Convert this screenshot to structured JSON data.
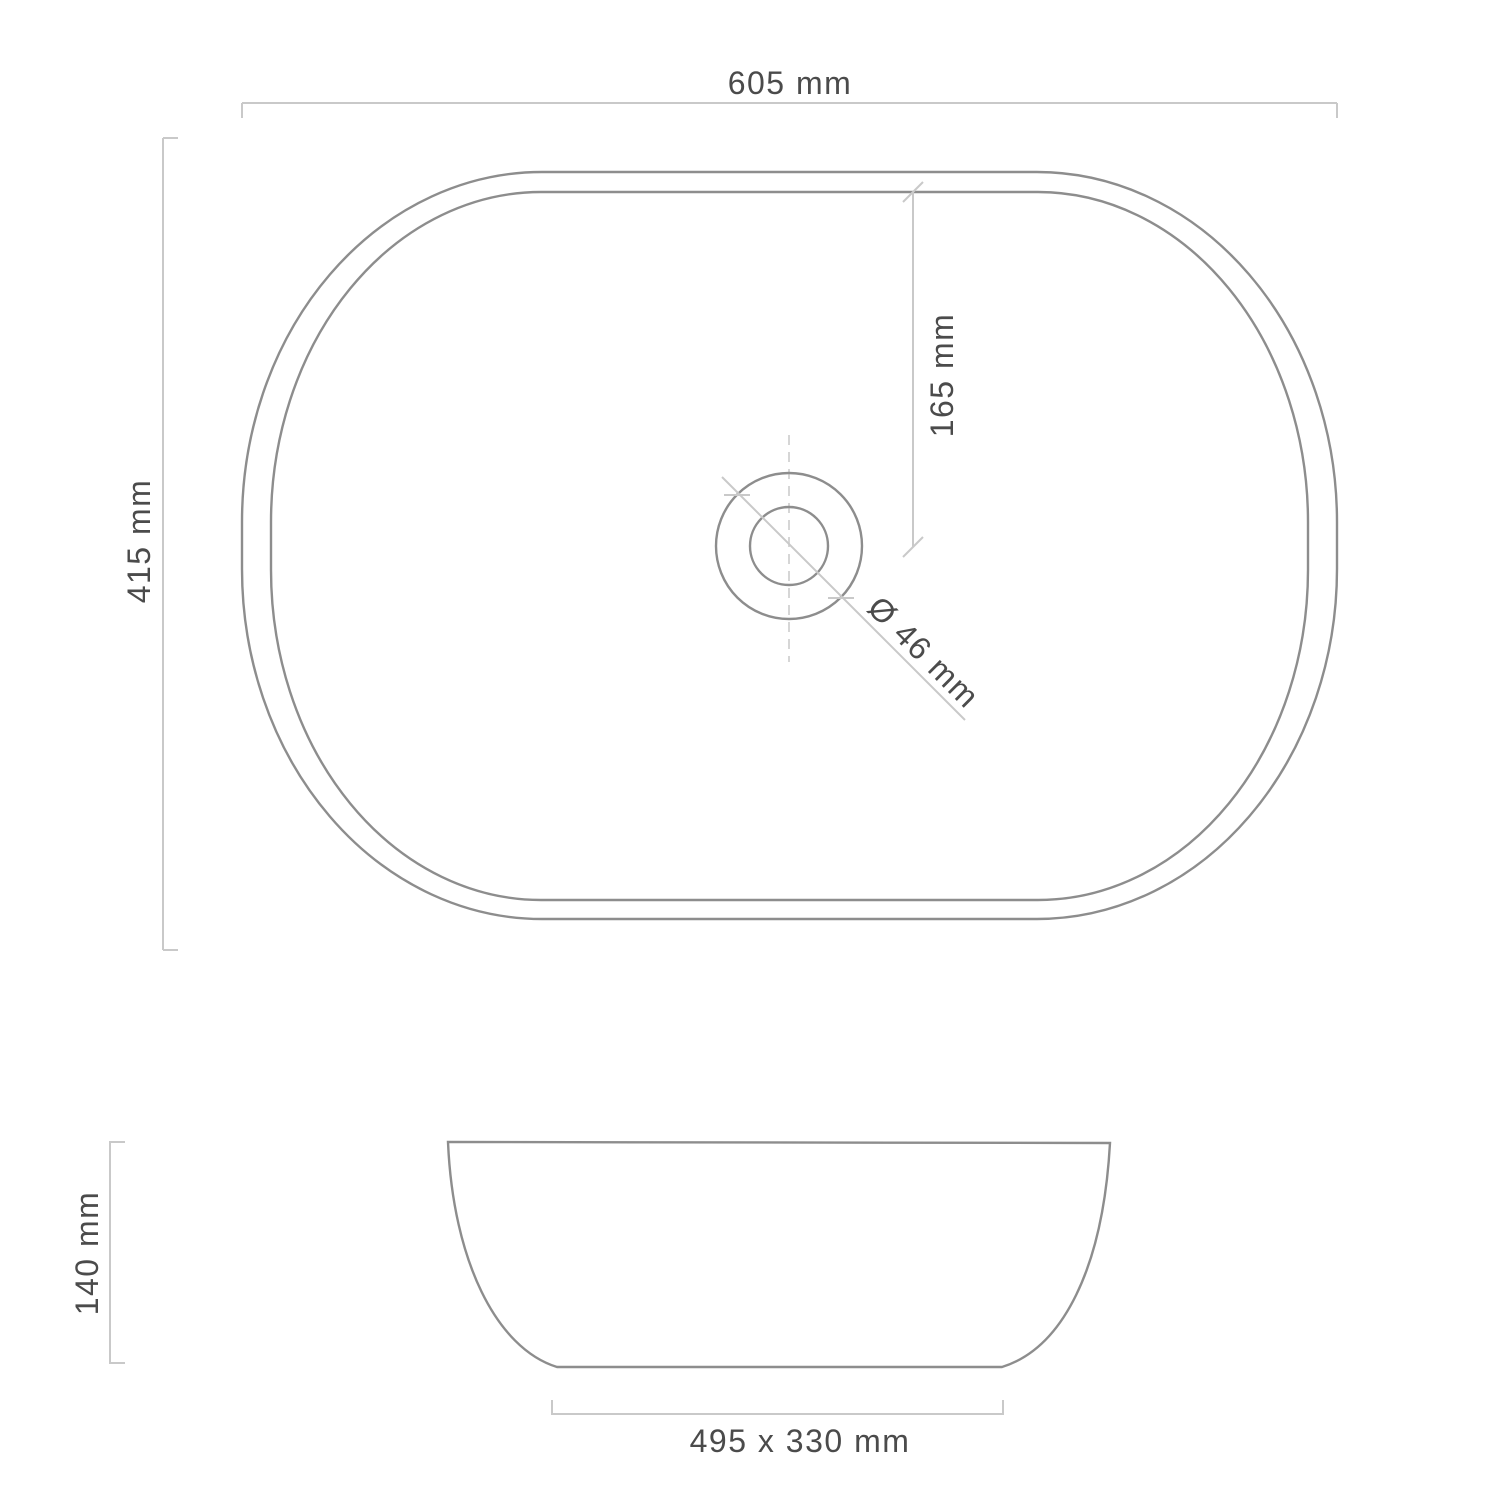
{
  "drawing": {
    "title": "Vessel basin technical drawing",
    "background_color": "#ffffff",
    "colors": {
      "object_line": "#8d8d8d",
      "dimension_line": "#c9c9c9",
      "centerline": "#d2d2d2",
      "label_text": "#4b4b4b"
    },
    "top_view": {
      "width_label": "605 mm",
      "height_label": "415 mm",
      "drain_offset_label": "165 mm",
      "drain_diameter_label": "Ø 46 mm"
    },
    "side_view": {
      "height_label": "140 mm",
      "base_label": "495 x 330 mm"
    }
  }
}
